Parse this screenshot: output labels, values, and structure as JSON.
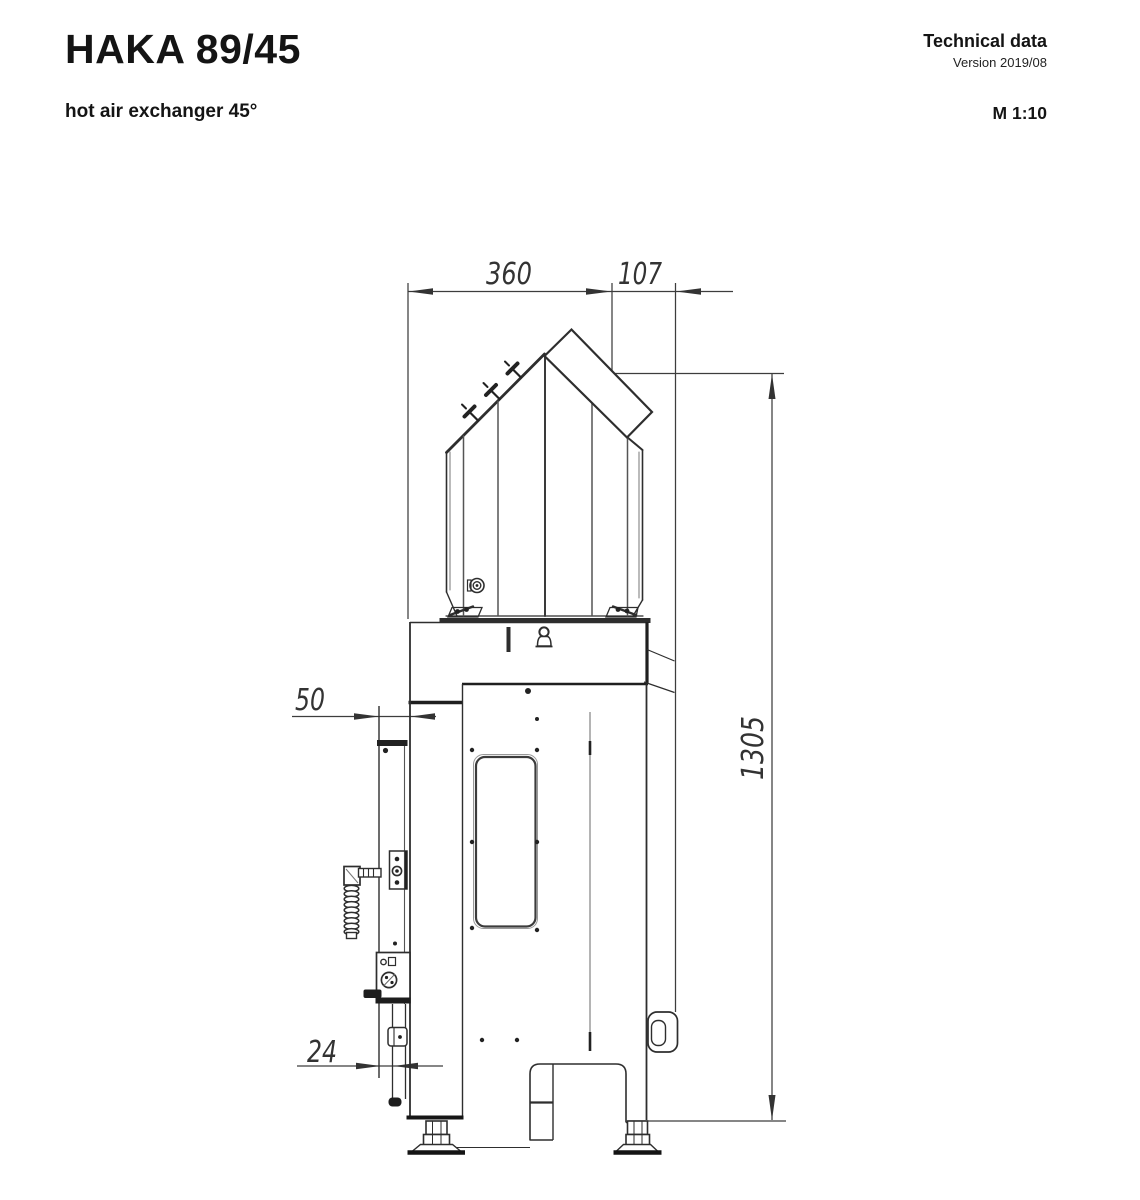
{
  "header": {
    "title": "HAKA 89/45",
    "subtitle": "hot air exchanger 45°",
    "doc_type": "Technical data",
    "version": "Version 2019/08",
    "scale": "M 1:10"
  },
  "drawing": {
    "dimensions_mm": {
      "hood_width": "360",
      "outlet_offset": "107",
      "total_height": "1305",
      "bracket_offset": "50",
      "rail_width": "24"
    }
  }
}
